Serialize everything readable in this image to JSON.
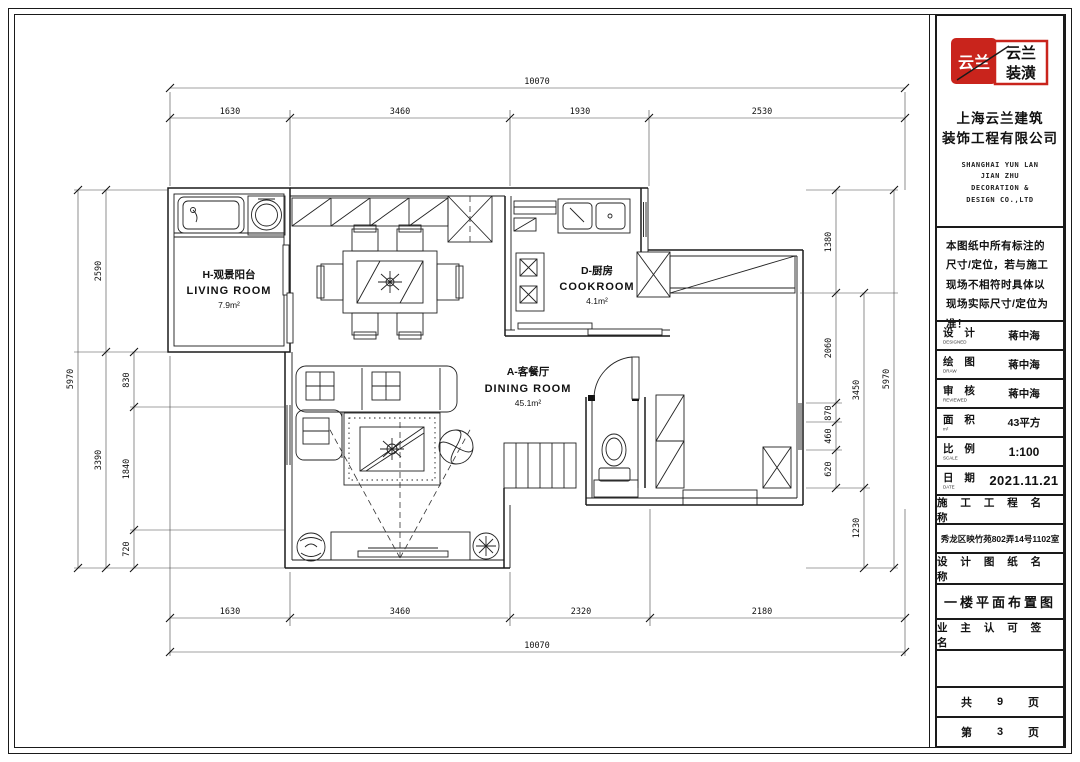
{
  "title_block": {
    "logo": {
      "seal_text": "云兰",
      "brand_line1": "云兰",
      "brand_line2": "装潢",
      "red": "#c9241c"
    },
    "company_cn_line1": "上海云兰建筑",
    "company_cn_line2": "装饰工程有限公司",
    "company_en_line1": "SHANGHAI YUN LAN",
    "company_en_line2": "JIAN ZHU",
    "company_en_line3": "DECORATION &",
    "company_en_line4": "DESIGN CO.,LTD",
    "notice": "本图纸中所有标注的尺寸/定位，若与施工现场不相符时具体以现场实际尺寸/定位为准！",
    "fields": [
      {
        "label": "设 计",
        "sub": "DESIGNED",
        "value": "蒋中海"
      },
      {
        "label": "绘 图",
        "sub": "DRAW",
        "value": "蒋中海"
      },
      {
        "label": "审 核",
        "sub": "REVIEWED",
        "value": "蒋中海"
      },
      {
        "label": "面 积",
        "sub": "m²",
        "value": "43平方"
      },
      {
        "label": "比 例",
        "sub": "SCALE",
        "value": "1:100"
      },
      {
        "label": "日 期",
        "sub": "DATE",
        "value": "2021.11.21"
      }
    ],
    "sections": {
      "project_header": "施 工 工 程 名 称",
      "project_value": "秀龙区映竹苑802弄14号1102室",
      "drawing_header": "设 计 图 纸 名 称",
      "drawing_value": "一楼平面布置图",
      "owner_sign_header": "业 主 认 可 签 名"
    },
    "pages": {
      "total_prefix": "共",
      "total_num": "9",
      "total_suffix": "页",
      "current_prefix": "第",
      "current_num": "3",
      "current_suffix": "页"
    }
  },
  "plan": {
    "rooms": [
      {
        "name": "H-观景阳台",
        "en": "LIVING ROOM",
        "area": "7.9m²"
      },
      {
        "name": "D-厨房",
        "en": "COOKROOM",
        "area": "4.1m²"
      },
      {
        "name": "A-客餐厅",
        "en": "DINING ROOM",
        "area": "45.1m²"
      }
    ],
    "dims": {
      "top_total": "10070",
      "top_segments": [
        "1630",
        "3460",
        "1930",
        "2530"
      ],
      "bottom_segments": [
        "1630",
        "3460",
        "2320",
        "2180"
      ],
      "bottom_total": "10070",
      "left_outer": "5970",
      "left_mid": [
        "2590",
        "3390"
      ],
      "left_inner": [
        "830",
        "1840",
        "720"
      ],
      "right_inner": [
        "1380",
        "2060",
        "870",
        "460",
        "620"
      ],
      "right_mid": [
        "3450",
        "1230"
      ],
      "right_outer": "5970"
    }
  }
}
